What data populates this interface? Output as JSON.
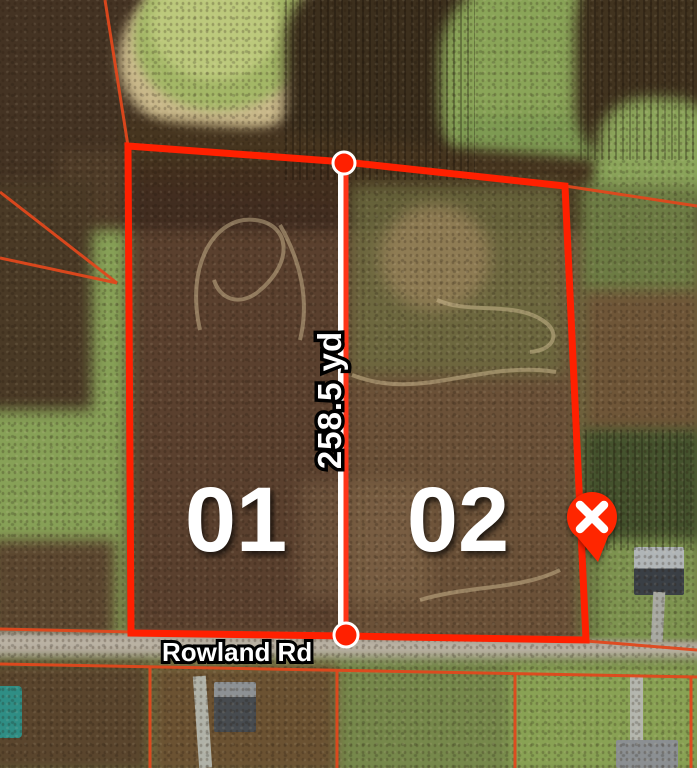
{
  "map": {
    "parcels": [
      {
        "label": "01"
      },
      {
        "label": "02"
      }
    ],
    "measurement": {
      "label": "258.5 yd"
    },
    "road": {
      "label": "Rowland Rd"
    },
    "marker": {
      "icon": "x-icon"
    },
    "colors": {
      "boundary": "#ff2000",
      "parcel_lines": "#e0481c",
      "measurement_line": "#ff3418",
      "label_text": "#ffffff"
    }
  }
}
